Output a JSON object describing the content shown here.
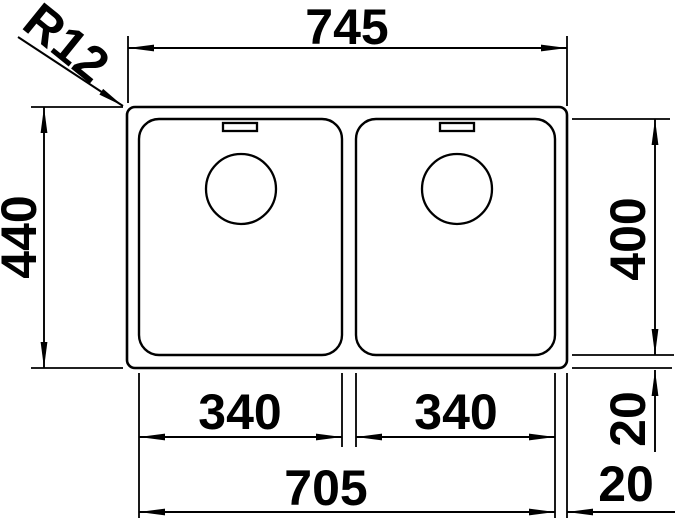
{
  "drawing": {
    "kind": "technical dimension drawing, top view, double-bowl sink",
    "colors": {
      "line": "#000000",
      "background": "#ffffff"
    },
    "labels": {
      "overall_width": "745",
      "overall_depth": "440",
      "bowl_depth": "400",
      "left_bowl_width": "340",
      "right_bowl_width": "340",
      "inner_span": "705",
      "right_edge_gap": "20",
      "bottom_edge_gap": "20",
      "corner_radius": "R12"
    }
  }
}
